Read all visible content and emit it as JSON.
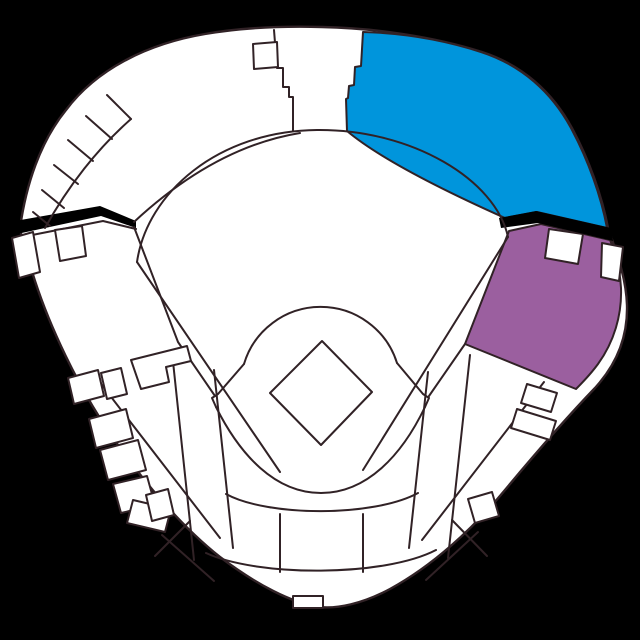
{
  "canvas": {
    "width": 640,
    "height": 640
  },
  "palette": {
    "background": "#000000",
    "outline": "#312226",
    "seating_default": "#ffffff",
    "highlight_blue": "#0095dc",
    "highlight_purple": "#9b5f9f"
  },
  "map": {
    "title": "Baseball stadium seating map",
    "sections": [
      {
        "id": "outfield-upper-right",
        "state": "highlighted",
        "color": "#0095dc"
      },
      {
        "id": "infield-upper-right",
        "state": "highlighted",
        "color": "#9b5f9f"
      },
      {
        "id": "general-seating",
        "state": "default",
        "color": "#ffffff"
      }
    ]
  }
}
